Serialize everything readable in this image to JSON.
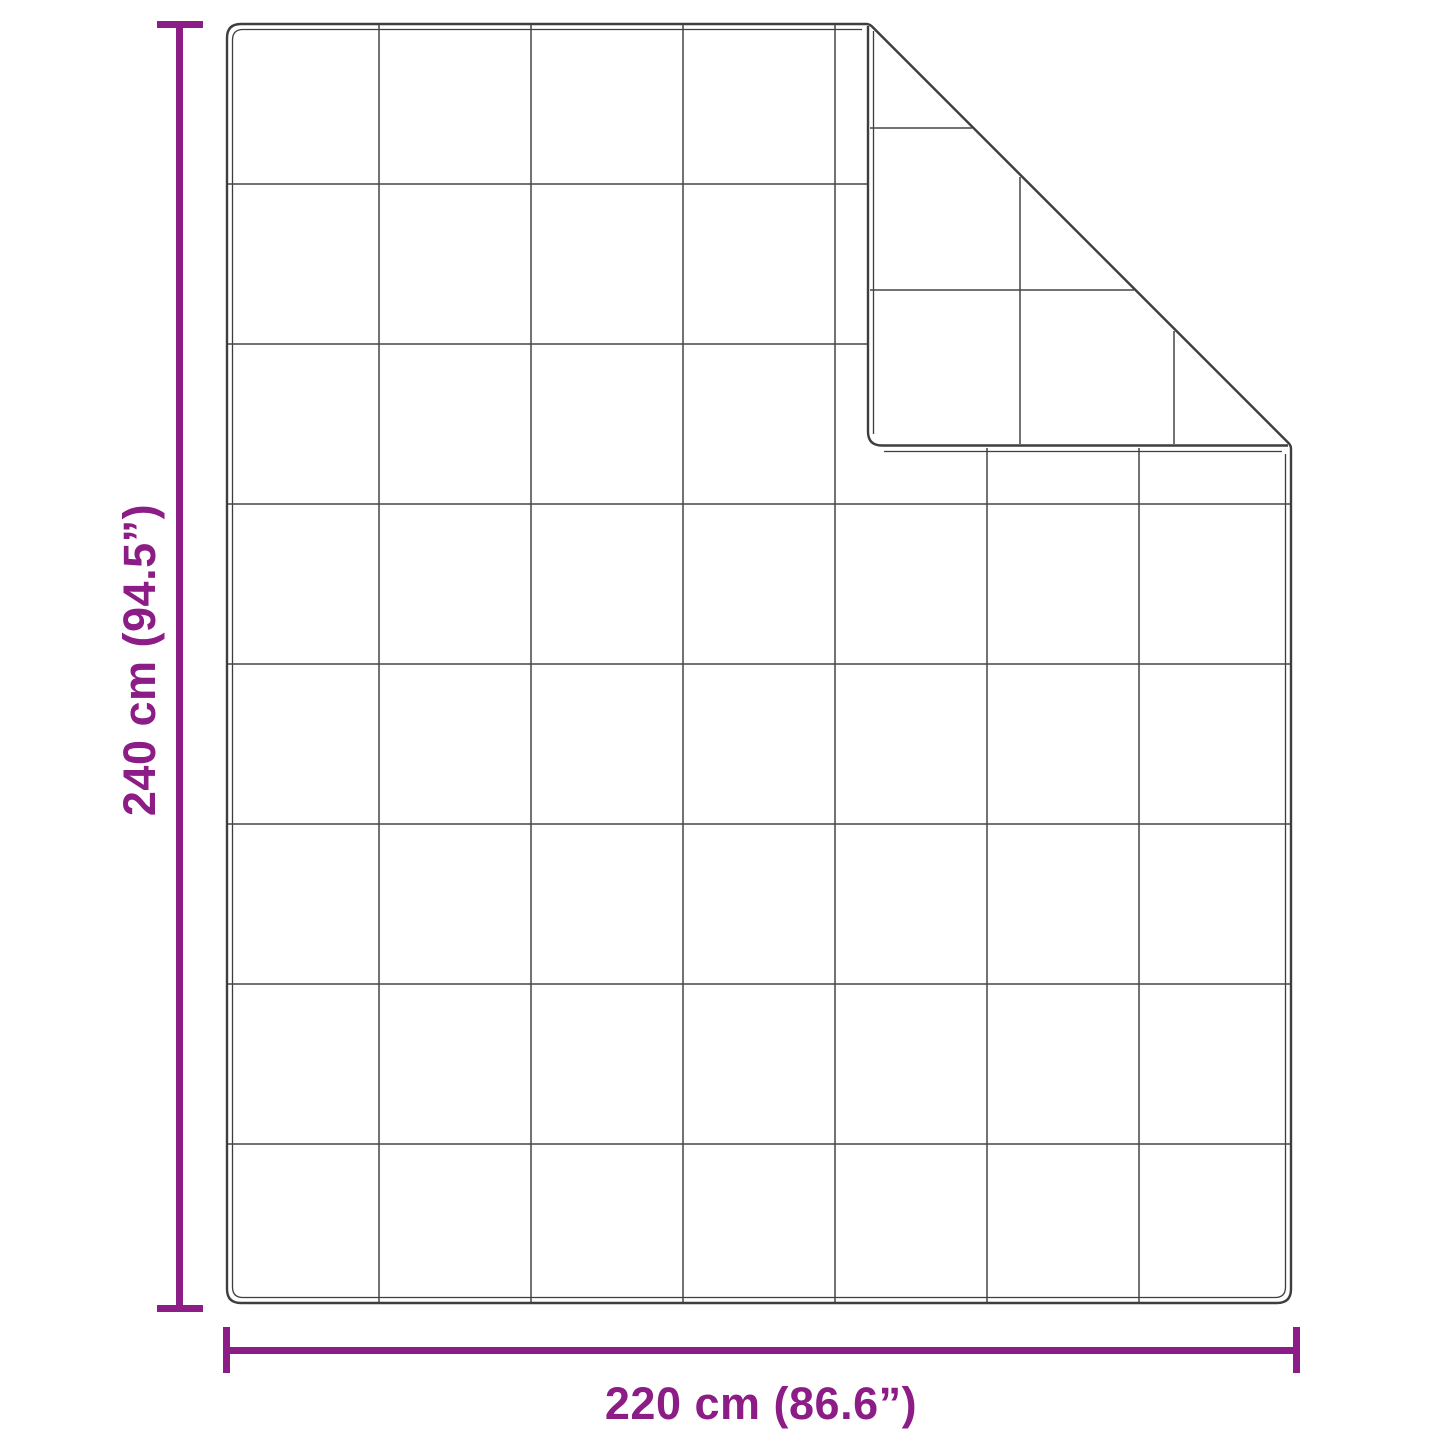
{
  "page": {
    "background_color": "#FFFFFF",
    "description": "Blanket dimension diagram with quilted grid and folded top-right corner"
  },
  "blanket": {
    "quilt_grid_columns": 7,
    "quilt_grid_rows": 8,
    "folded_corner": "top-right",
    "outline_color": "#3E3E3E",
    "grid_line_color": "#454545"
  },
  "dimensions": {
    "accent_color": "#8C1C86",
    "height": {
      "label": "240 cm (94.5”)",
      "value_cm": 240,
      "value_inches": 94.5
    },
    "width": {
      "label": "220 cm (86.6”)",
      "value_cm": 220,
      "value_inches": 86.6
    }
  }
}
